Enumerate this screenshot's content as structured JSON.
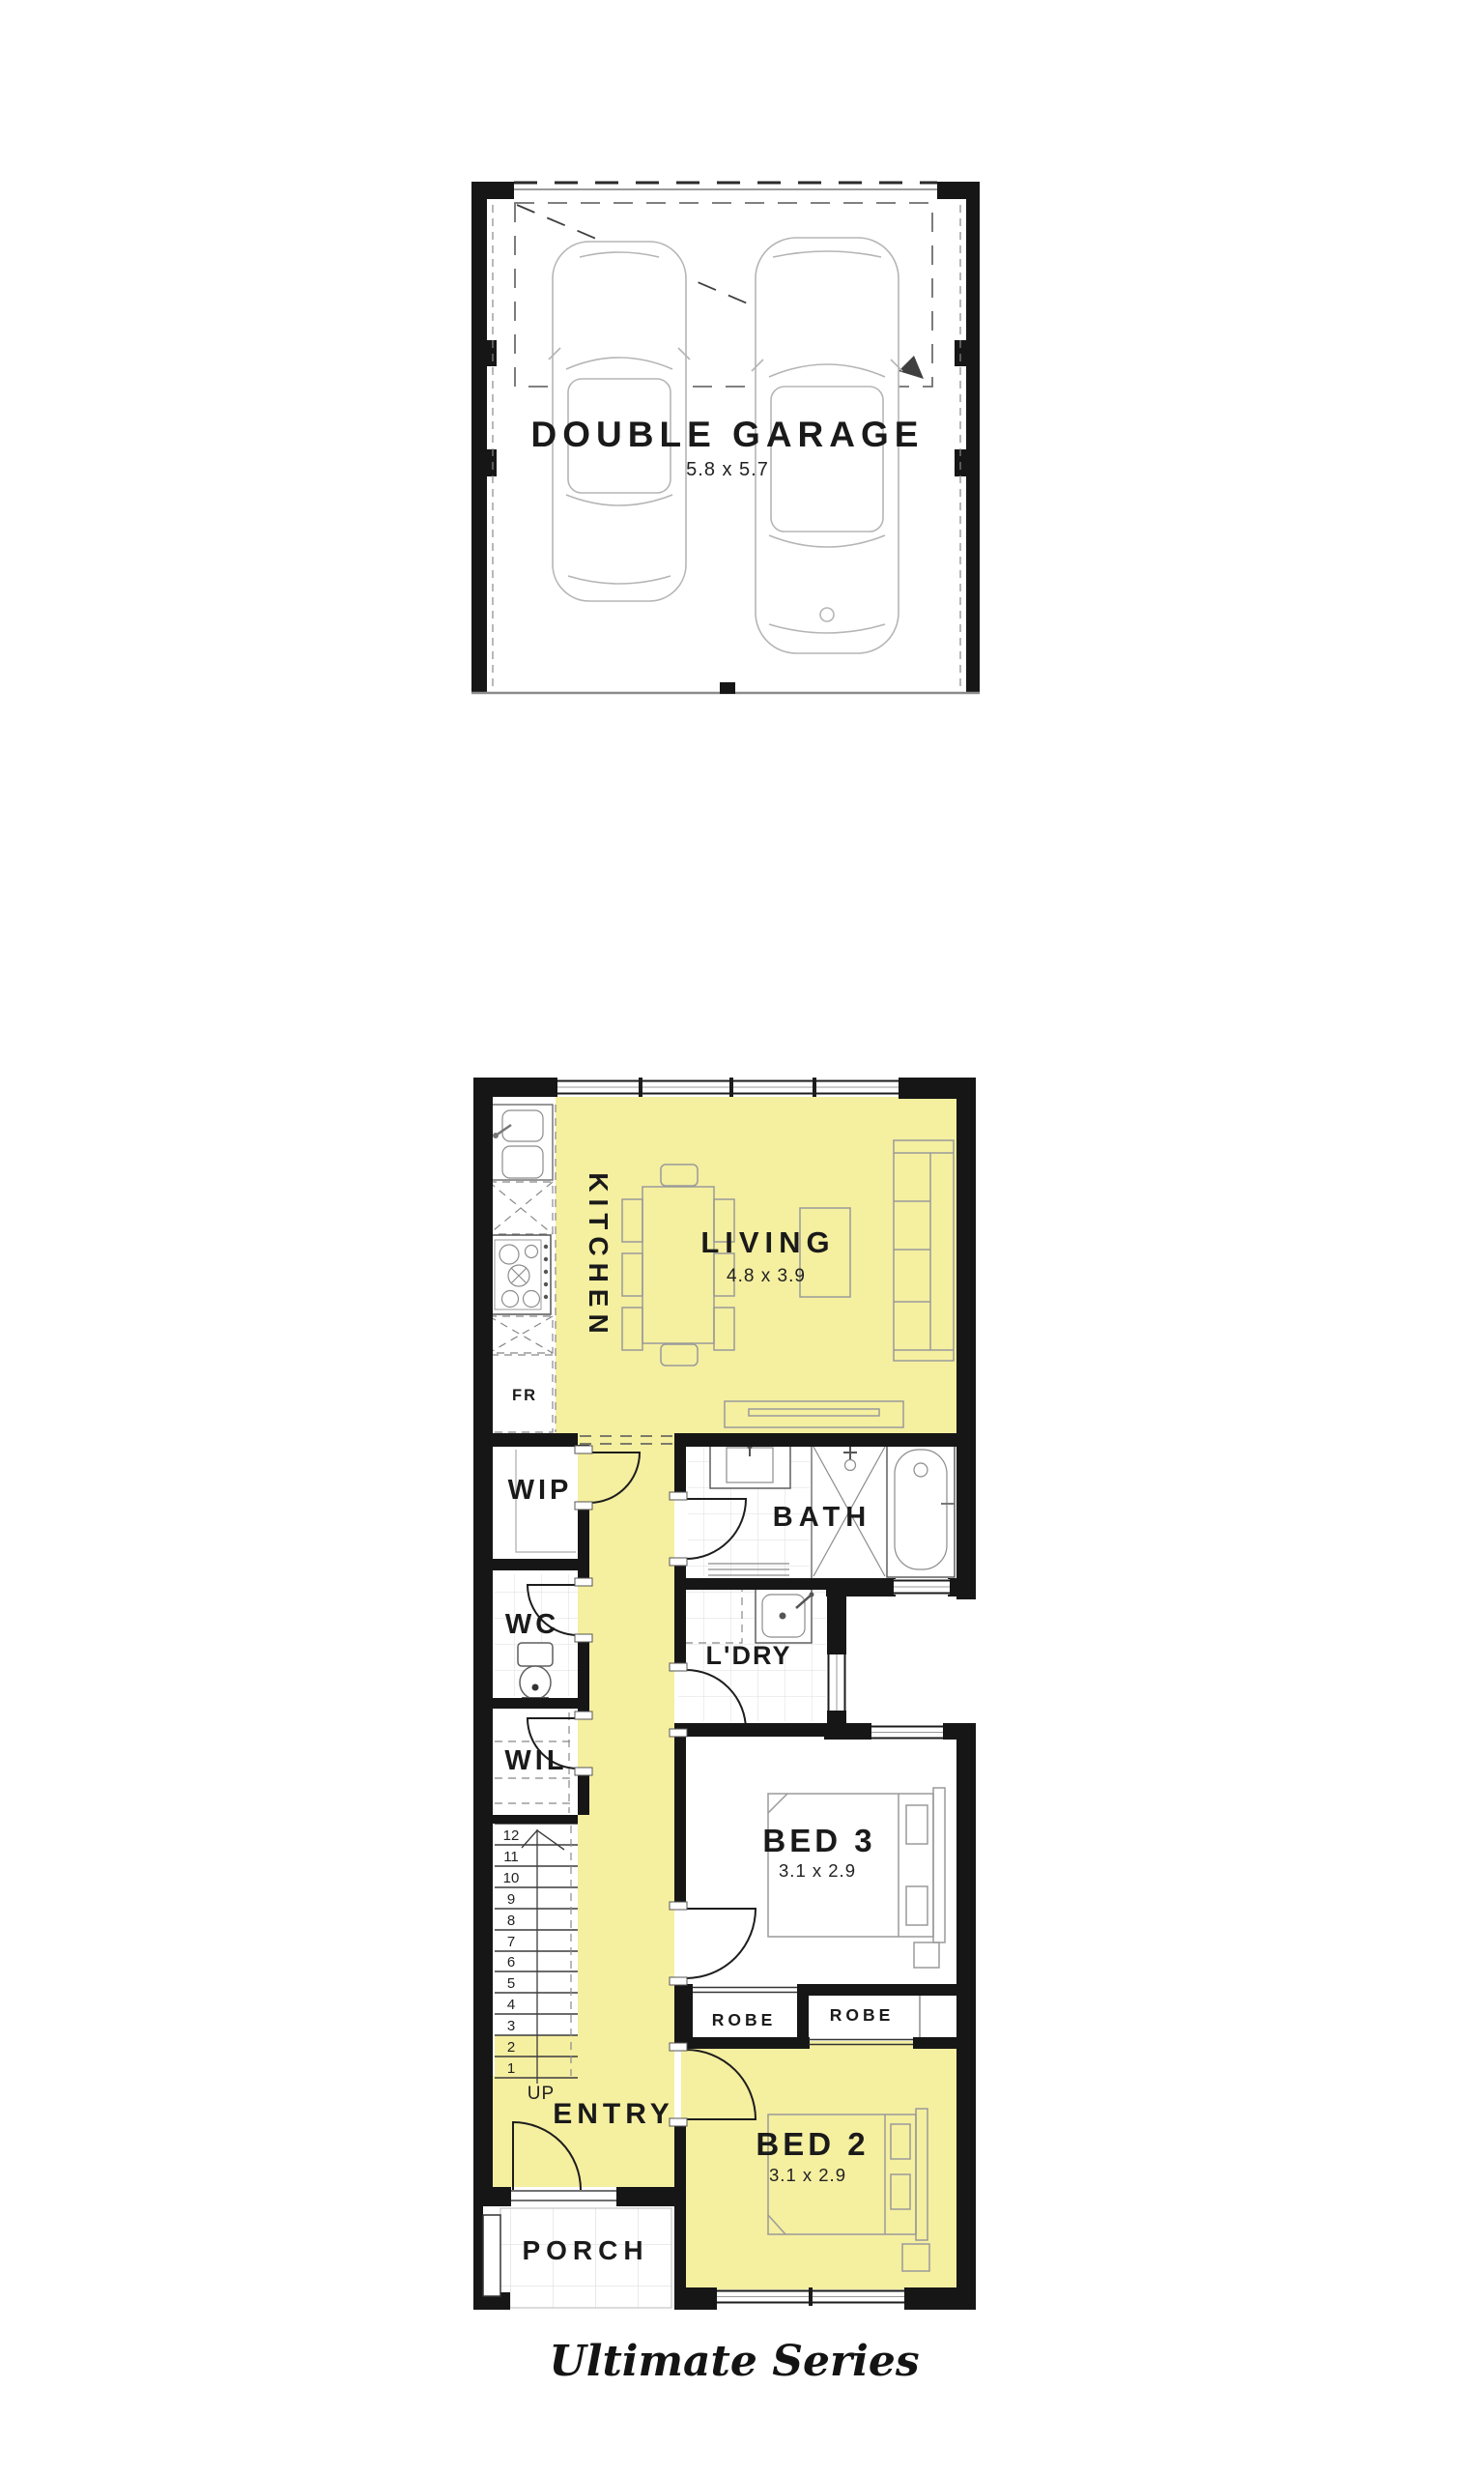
{
  "colors": {
    "highlight": "#f5efa0",
    "wall": "#161616"
  },
  "garage": {
    "label": "DOUBLE GARAGE",
    "dims": "5.8 x 5.7"
  },
  "rooms": {
    "kitchen": {
      "label": "KITCHEN"
    },
    "living": {
      "label": "LIVING",
      "dims": "4.8 x 3.9"
    },
    "wip": {
      "label": "WIP"
    },
    "bath": {
      "label": "BATH"
    },
    "wc": {
      "label": "WC"
    },
    "ldry": {
      "label": "L'DRY"
    },
    "wil": {
      "label": "WIL"
    },
    "bed3": {
      "label": "BED 3",
      "dims": "3.1 x 2.9"
    },
    "robe_left": {
      "label": "ROBE"
    },
    "robe_right": {
      "label": "ROBE"
    },
    "entry": {
      "label": "ENTRY"
    },
    "bed2": {
      "label": "BED 2",
      "dims": "3.1 x 2.9"
    },
    "porch": {
      "label": "PORCH"
    }
  },
  "kitchen_items": {
    "fridge": "FR"
  },
  "stairs": {
    "up": "UP",
    "steps": [
      "12",
      "11",
      "10",
      "9",
      "8",
      "7",
      "6",
      "5",
      "4",
      "3",
      "2",
      "1"
    ]
  },
  "footer": {
    "series": "Ultimate Series"
  }
}
